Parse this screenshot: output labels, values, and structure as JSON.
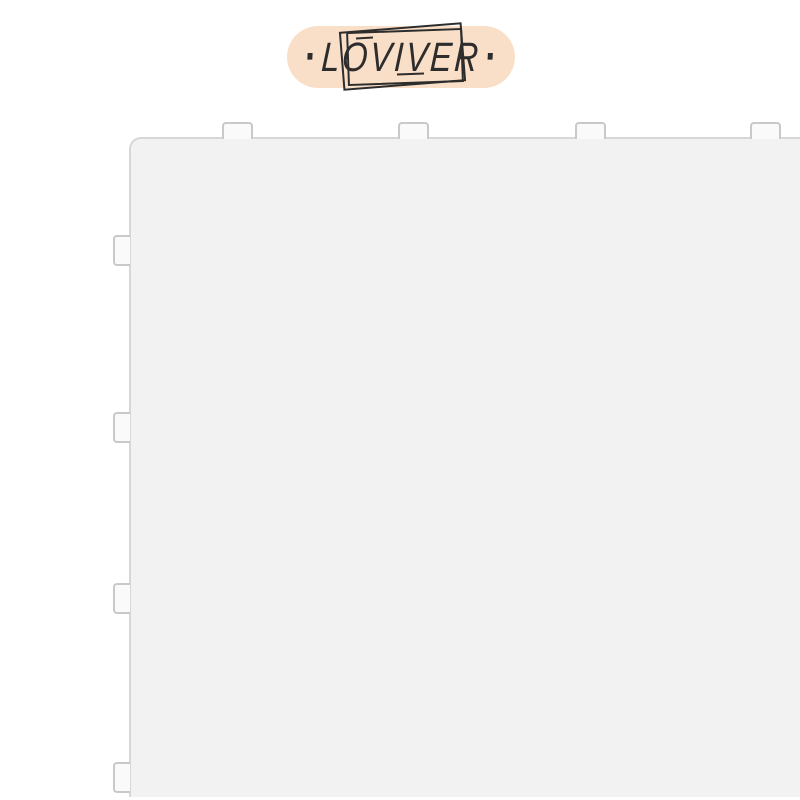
{
  "theme": {
    "page-bg": "#ffffff",
    "badge-bg": "#fadfc8",
    "logo-ink": "#2d2d2d",
    "tile-fill": "#f2f2f3",
    "tile-edge": "#d7d7d7",
    "tab-fill": "#fafafa",
    "tab-edge": "#c9c9c9"
  },
  "brand_badge": {
    "left_dot": "·",
    "name": "LOVIVER",
    "right_dot": "·"
  }
}
